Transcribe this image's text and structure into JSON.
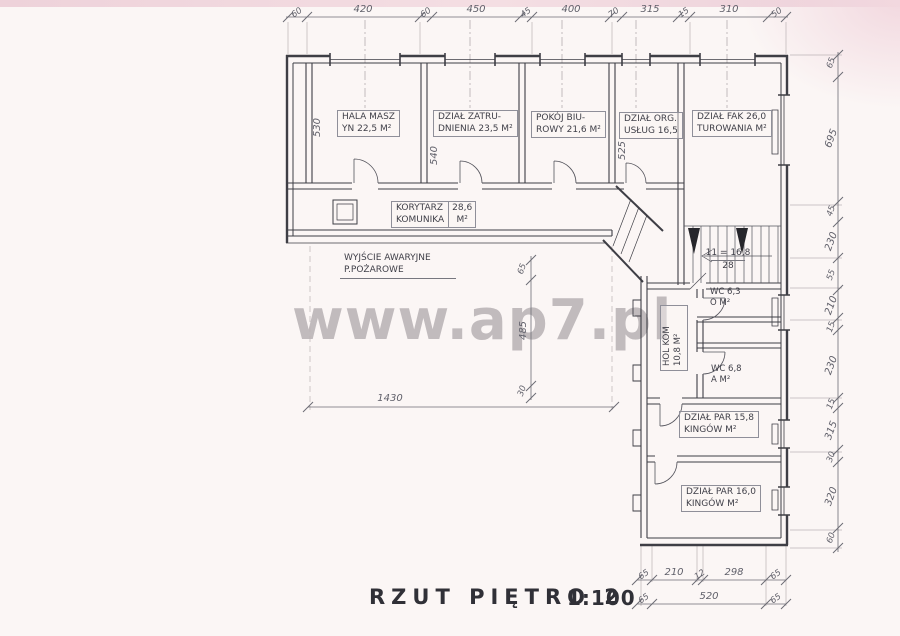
{
  "page": {
    "title": "RZUT PIĘTRO 2",
    "scale": "1:100",
    "watermark": "www.ap7.pl"
  },
  "rooms": [
    {
      "id": "hala-maszyn",
      "line1": "HALA MASZ",
      "line2": "YN 22,5 M²"
    },
    {
      "id": "dzial-zatrudnienia",
      "line1": "DZIAŁ ZATRU-",
      "line2": "DNIENIA 23,5 M²"
    },
    {
      "id": "pokoj-biurowy",
      "line1": "POKÓJ BIU-",
      "line2": "ROWY 21,6 M²"
    },
    {
      "id": "dzial-org-uslug",
      "line1": "DZIAŁ ORG.",
      "line2": "USŁUG 16,5"
    },
    {
      "id": "dzial-fakturowania",
      "line1": "DZIAŁ FAK 26,0",
      "line2": "TUROWANIA M²"
    },
    {
      "id": "korytarz",
      "line1": "KORYTARZ",
      "line2": "KOMUNIKA",
      "area": "28,6",
      "unit": "M²"
    },
    {
      "id": "wyjscie-awaryjne",
      "line1": "WYJŚCIE AWARYJNE",
      "line2": "P.POŻAROWE"
    },
    {
      "id": "schody",
      "line1": "11 = 16,8",
      "line2": "28"
    },
    {
      "id": "wc-gorne",
      "line1": "WC 6,3",
      "line2": "O M²"
    },
    {
      "id": "hol-komunikacja",
      "line1": "HOL KOM",
      "line2": "10,8 M²"
    },
    {
      "id": "wc-dolne",
      "line1": "WC 6,8",
      "line2": "A M²"
    },
    {
      "id": "dzial-parkingow-1",
      "line1": "DZIAŁ PAR 15,8",
      "line2": "KINGÓW M²"
    },
    {
      "id": "dzial-parkingow-2",
      "line1": "DZIAŁ PAR 16,0",
      "line2": "KINGÓW M²"
    }
  ],
  "dims": {
    "top": [
      "60",
      "420",
      "60",
      "450",
      "45",
      "400",
      "70",
      "315",
      "15",
      "310",
      "50"
    ],
    "right": [
      "65",
      "695",
      "45",
      "230",
      "55",
      "210",
      "15",
      "230",
      "15",
      "315",
      "30",
      "320",
      "60"
    ],
    "b1": [
      "65",
      "210",
      "12",
      "298",
      "65"
    ],
    "b2": [
      "65",
      "520",
      "65"
    ],
    "inner": {
      "room1": "530",
      "room2": "540",
      "room5": "525",
      "court_w": "1430",
      "court_h": "485",
      "court_t1": "65",
      "court_t2": "30"
    }
  }
}
